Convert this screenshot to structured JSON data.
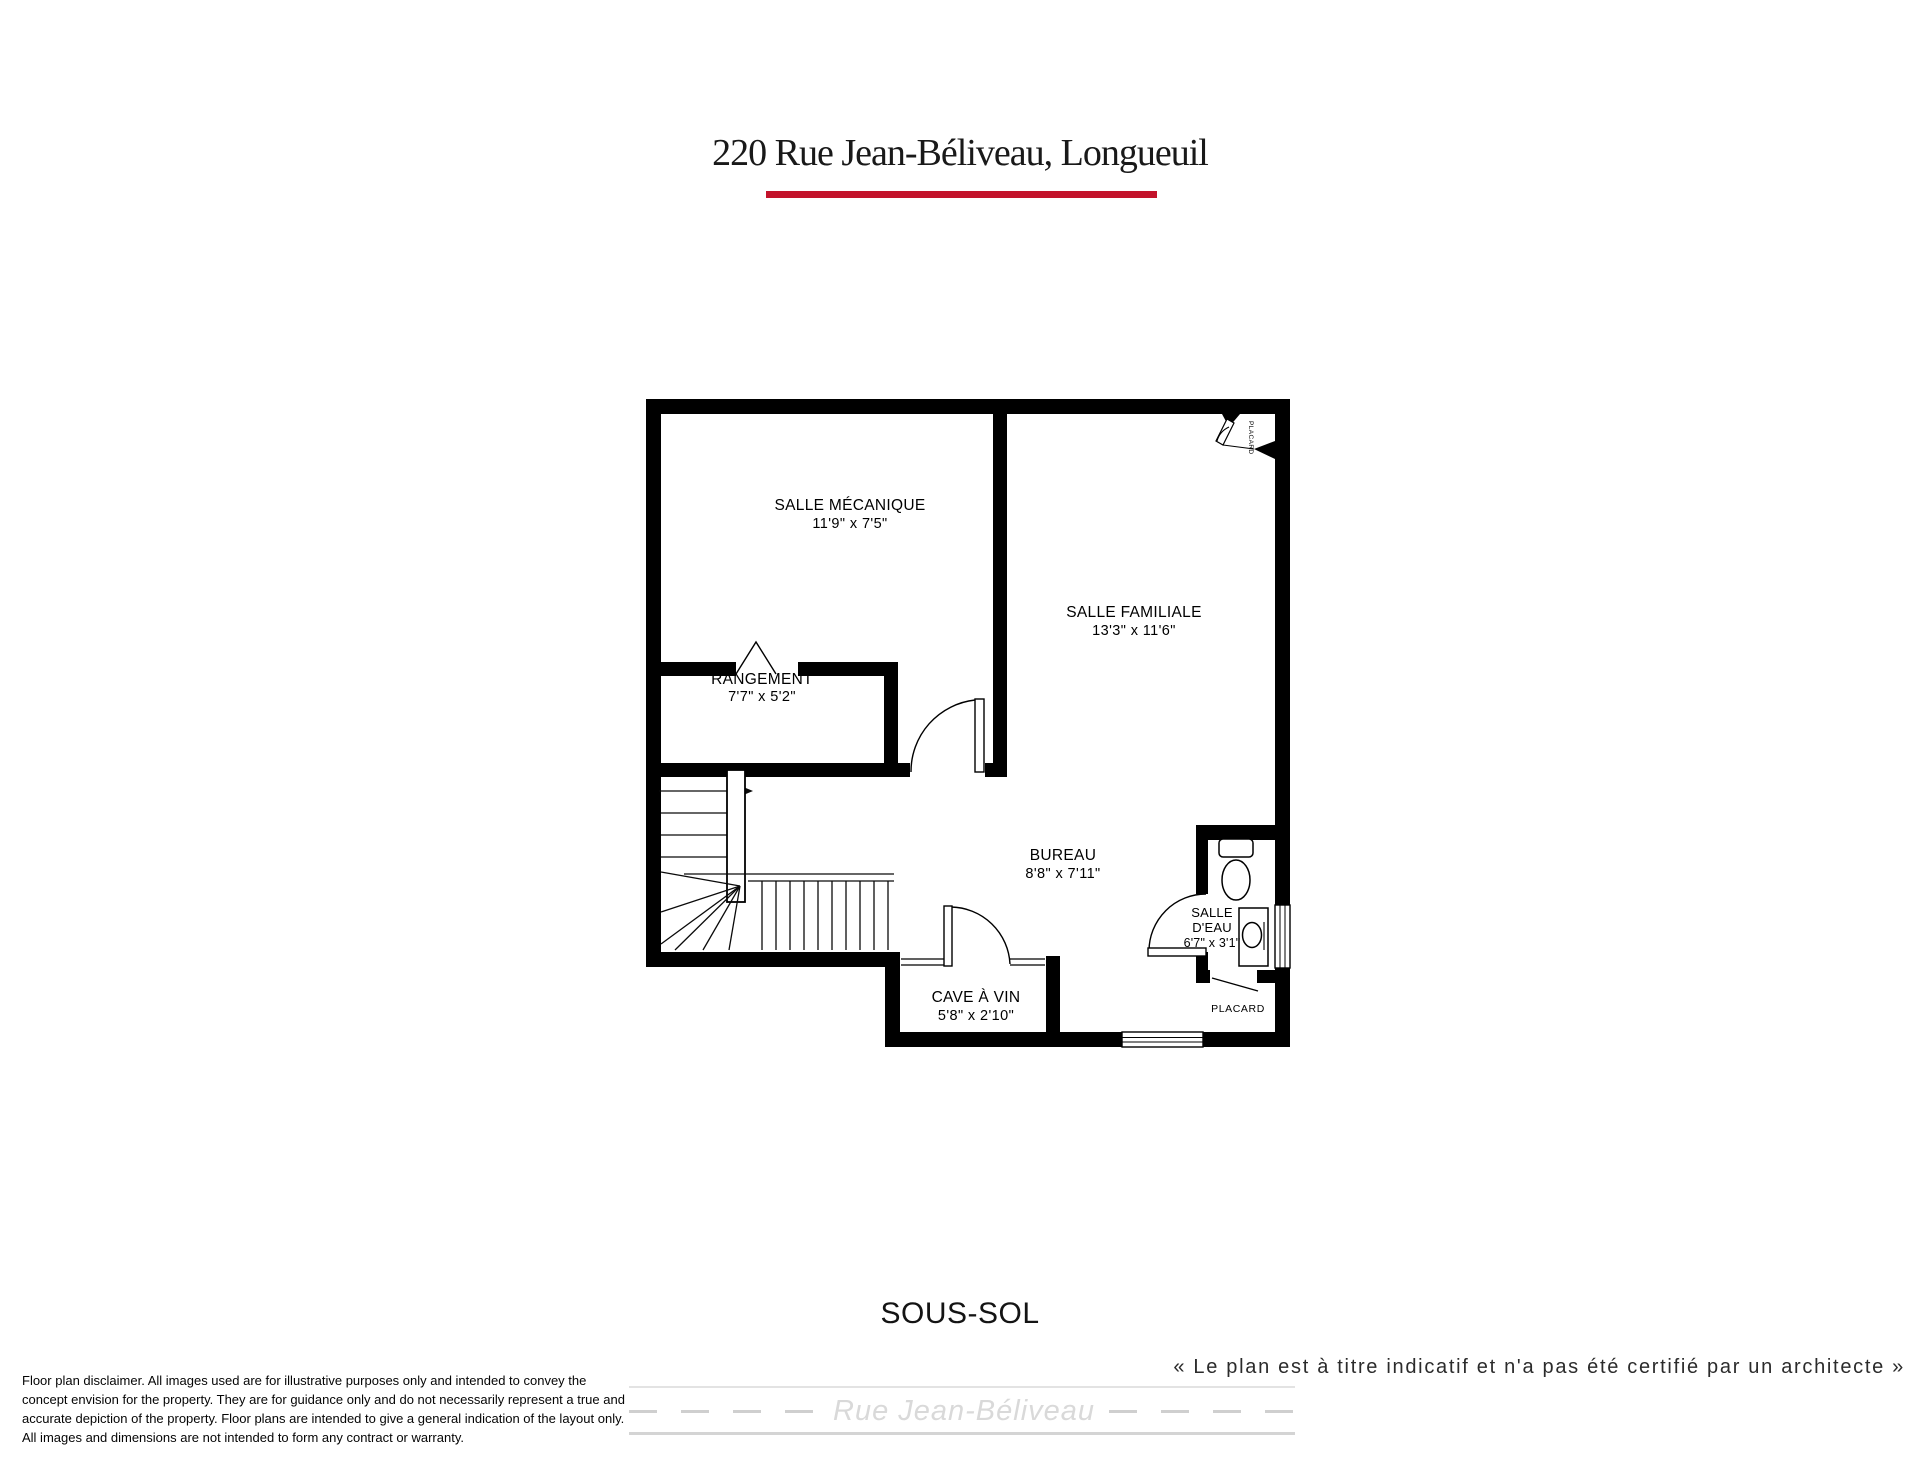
{
  "header": {
    "title": "220 Rue Jean-Béliveau, Longueuil",
    "underline_color": "#c3132b"
  },
  "plan": {
    "floor_label": "SOUS-SOL",
    "wall_color": "#000000",
    "rooms": {
      "salle_mecanique": {
        "name": "SALLE MÉCANIQUE",
        "dims": "11'9\" x 7'5\""
      },
      "rangement": {
        "name": "RANGEMENT",
        "dims": "7'7\" x 5'2\""
      },
      "salle_familiale": {
        "name": "SALLE FAMILIALE",
        "dims": "13'3\" x 11'6\""
      },
      "bureau": {
        "name": "BUREAU",
        "dims": "8'8\" x 7'11\""
      },
      "salle_eau": {
        "name_line1": "SALLE",
        "name_line2": "D'EAU",
        "dims": "6'7\" x 3'1\""
      },
      "cave_a_vin": {
        "name": "CAVE À VIN",
        "dims": "5'8\" x 2'10\""
      },
      "placard": {
        "name": "PLACARD"
      },
      "placard_corner": {
        "name": "PLACARD"
      }
    }
  },
  "footer": {
    "quote": "« Le plan est à titre indicatif et n'a pas été certifié par un architecte »",
    "street_name": "Rue Jean-Béliveau",
    "disclaimer_lines": [
      "Floor plan disclaimer. All images used are for illustrative purposes only and intended to convey the",
      "concept envision for the property. They are for guidance only and do not necessarily represent a true and",
      "accurate depiction of the property. Floor plans are intended to give a general indication of the layout only.",
      "All images and dimensions are not intended to form any contract or warranty."
    ]
  }
}
